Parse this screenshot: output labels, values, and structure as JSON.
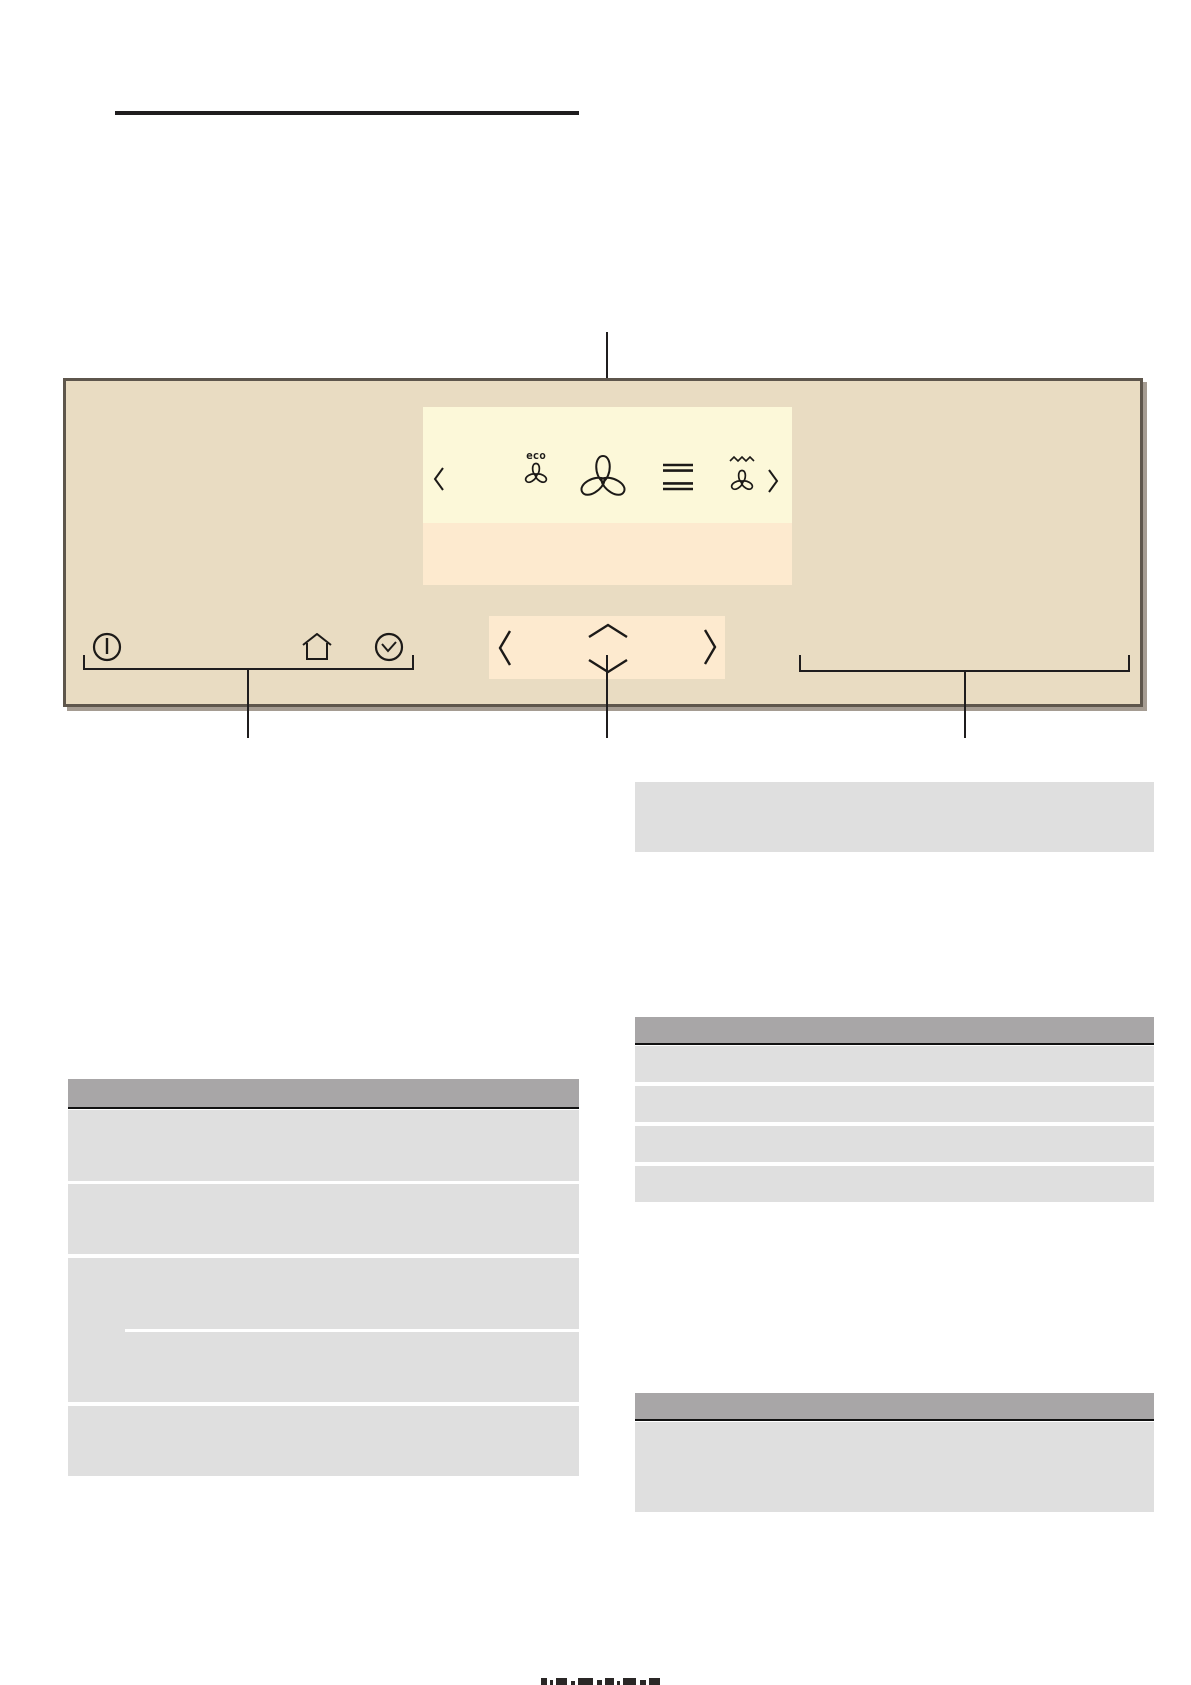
{
  "heading": {
    "title": "",
    "underline": true
  },
  "panel": {
    "description": "appliance control panel illustration",
    "display": {
      "eco_label": "eco",
      "selected_mode": "fan",
      "modes": [
        {
          "icon": "chevron-left-icon",
          "label": ""
        },
        {
          "icon": "eco-fan-icon",
          "label": "eco"
        },
        {
          "icon": "fan-icon",
          "label": "",
          "selected": true
        },
        {
          "icon": "top-bottom-heat-icon",
          "label": ""
        },
        {
          "icon": "grill-fan-icon",
          "label": ""
        },
        {
          "icon": "chevron-right-icon",
          "label": ""
        }
      ]
    },
    "buttons": [
      {
        "icon": "power-icon",
        "label": ""
      },
      {
        "icon": "home-icon",
        "label": ""
      },
      {
        "icon": "timer-clock-icon",
        "label": ""
      }
    ],
    "navigation": [
      {
        "icon": "chevron-left-icon"
      },
      {
        "icon": "chevron-up-icon"
      },
      {
        "icon": "chevron-down-icon"
      },
      {
        "icon": "chevron-right-icon"
      }
    ]
  },
  "callouts": {
    "top_line": true,
    "left_bracket": true,
    "center_line": true,
    "right_bracket": true
  },
  "tables": {
    "left": {
      "header": "",
      "rows": [
        "",
        "",
        "",
        "",
        ""
      ]
    },
    "right": {
      "note_box": "",
      "block1_header": "",
      "block1_rows": [
        "",
        "",
        "",
        ""
      ],
      "block2_header": "",
      "block2_rows": [
        ""
      ]
    }
  },
  "colors": {
    "panel_bg": "#e9dcc2",
    "panel_border": "#5e564c",
    "display_bg": "#fcf8d9",
    "display_strip": "#fdeacf",
    "arrow_strip": "#fdeacf",
    "table_header": "#a8a6a7",
    "table_row": "#dfdfdf",
    "rule": "#1f1d1e",
    "icon_stroke": "#1c1a18"
  }
}
